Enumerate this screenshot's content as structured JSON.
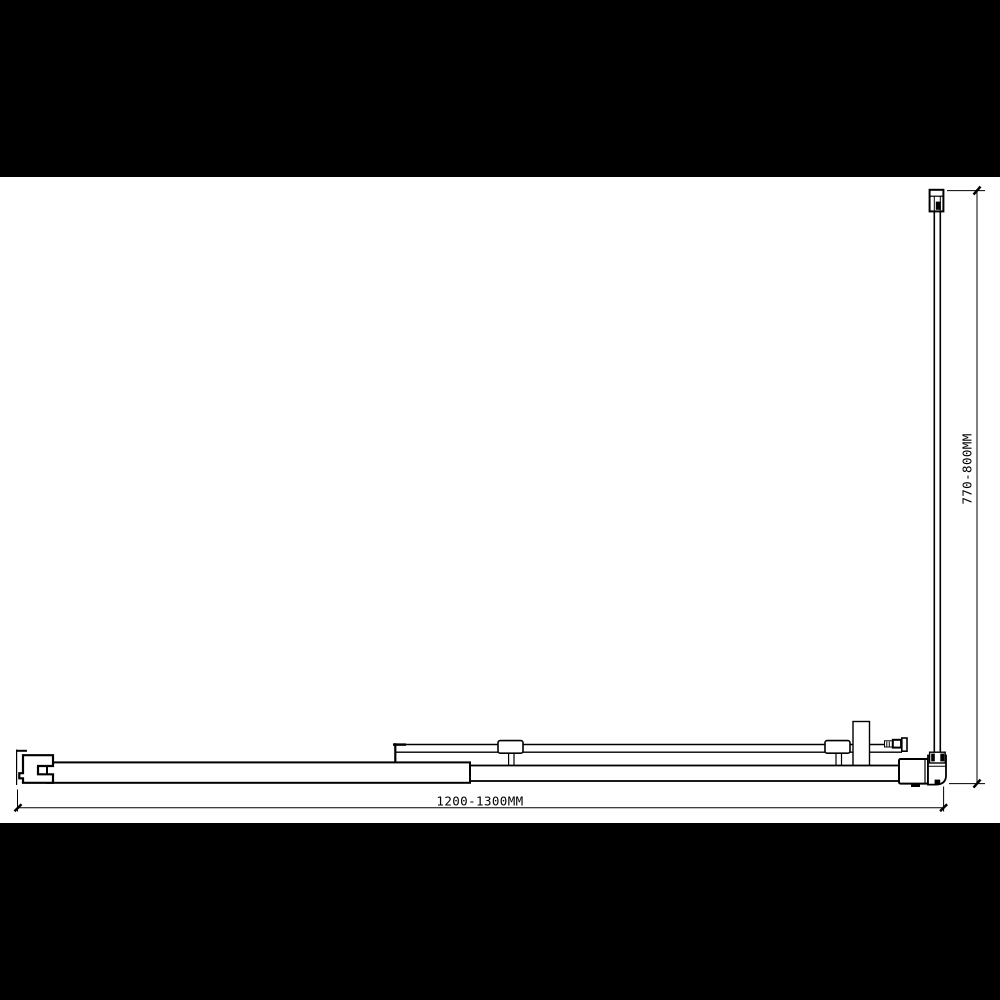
{
  "diagram": {
    "type": "technical-line-drawing",
    "view": "top-view shower screen with return panel",
    "dimensions": {
      "width_label": "1200-1300MM",
      "depth_label": "770-800MM"
    }
  },
  "colors": {
    "letterbox": "#000000",
    "canvas": "#ffffff",
    "line": "#000000"
  }
}
